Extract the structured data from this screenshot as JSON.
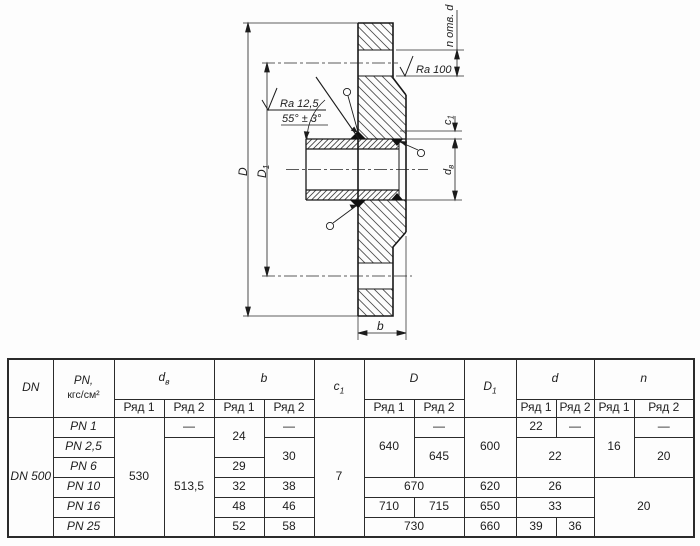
{
  "drawing": {
    "labels": {
      "outer_diameter": "D",
      "bolt_circle_base": "D",
      "bolt_circle_sub": "1",
      "thickness": "b",
      "ledge_base": "c",
      "ledge_sub": "1",
      "bore_base": "d",
      "bore_sub": "в",
      "holes_note": "n отв. d",
      "roughness_face": "Ra 100",
      "roughness_bevel": "Ra 12,5",
      "bevel_angle": "55° ± 3°"
    }
  },
  "table": {
    "headers": {
      "dn": "DN",
      "pn_line1": "PN,",
      "pn_line2": "кгс/см²",
      "dv_base": "d",
      "dv_sub": "в",
      "b": "b",
      "c1_base": "c",
      "c1_sub": "1",
      "D": "D",
      "D1_base": "D",
      "D1_sub": "1",
      "d": "d",
      "n": "n",
      "row1": "Ряд 1",
      "row2": "Ряд 2"
    },
    "dn_value": "DN 500",
    "pn_rows": [
      "PN 1",
      "PN 2,5",
      "PN 6",
      "PN 10",
      "PN 16",
      "PN 25"
    ],
    "cells": {
      "dv_r1": "530",
      "dv_r2_pn1": "—",
      "dv_r2_rest": "513,5",
      "b_r1_pn1": "24",
      "b_r1_pn6": "29",
      "b_r1_pn10": "32",
      "b_r1_pn16": "48",
      "b_r1_pn25": "52",
      "b_r2_pn1": "—",
      "b_r2_pn25_30": "30",
      "b_r2_pn10": "38",
      "b_r2_pn16": "46",
      "b_r2_pn25": "58",
      "c1": "7",
      "D_r1_top": "640",
      "D_r2_pn1": "—",
      "D_r2_mid": "645",
      "D_pn10": "670",
      "D_r1_pn16": "710",
      "D_r2_pn16": "715",
      "D_pn25": "730",
      "D1_top": "600",
      "D1_pn10": "620",
      "D1_pn16": "650",
      "D1_pn25": "660",
      "d_r1_pn1": "22",
      "d_r2_pn1": "—",
      "d_mid": "22",
      "d_pn10": "26",
      "d_pn16": "33",
      "d_r1_pn25": "39",
      "d_r2_pn25": "36",
      "n_r1_top": "16",
      "n_r2_pn1": "—",
      "n_r2_mid": "20",
      "n_bottom": "20"
    }
  }
}
